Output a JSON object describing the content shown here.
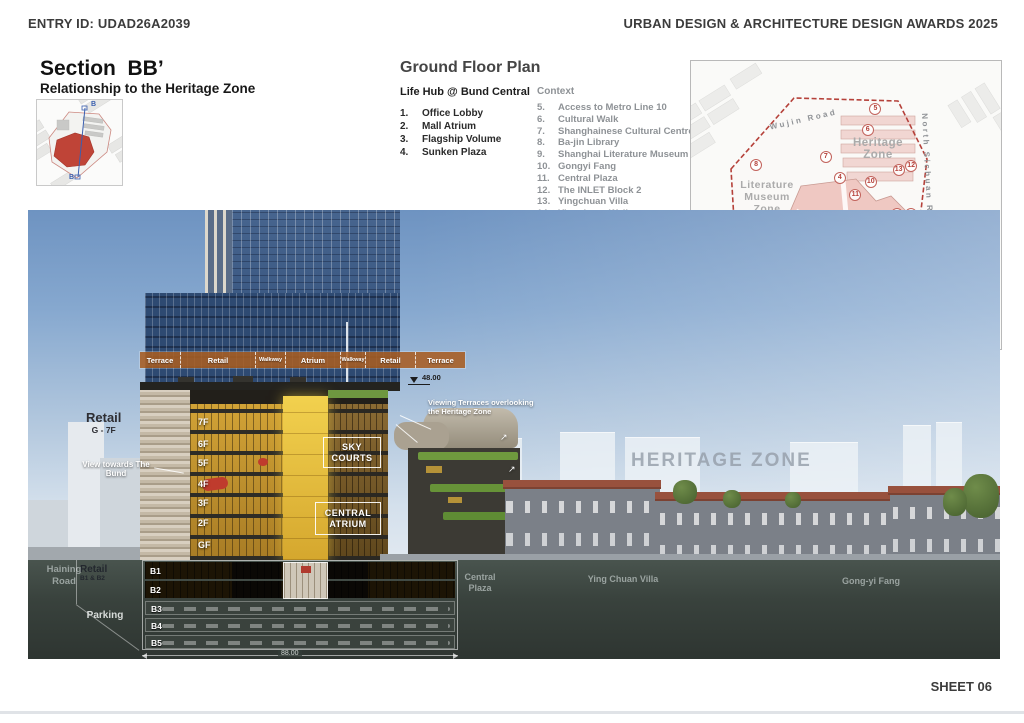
{
  "page": {
    "entry_id": "ENTRY ID: UDAD26A2039",
    "award_title": "URBAN DESIGN & ARCHITECTURE DESIGN AWARDS 2025",
    "sheet_no": "SHEET 06"
  },
  "title": {
    "heading": "Section  BB’",
    "subheading": "Relationship to the Heritage Zone",
    "keyplan_mark_top": "B",
    "keyplan_mark_bottom": "B"
  },
  "gfp": {
    "heading": "Ground Floor Plan",
    "subheading": "Life Hub @ Bund Central",
    "items": [
      {
        "num": "1.",
        "label": "Office Lobby"
      },
      {
        "num": "2.",
        "label": "Mall Atrium"
      },
      {
        "num": "3.",
        "label": "Flagship Volume"
      },
      {
        "num": "4.",
        "label": "Sunken Plaza"
      }
    ]
  },
  "ctx": {
    "heading": "Context",
    "items": [
      {
        "num": "5.",
        "label": "Access to Metro Line 10"
      },
      {
        "num": "6.",
        "label": "Cultural Walk"
      },
      {
        "num": "7.",
        "label": "Shanghainese Cultural Centre"
      },
      {
        "num": "8.",
        "label": "Ba-jin Library"
      },
      {
        "num": "9.",
        "label": "Shanghai Literature Museum"
      },
      {
        "num": "10.",
        "label": "Gongyi Fang"
      },
      {
        "num": "11.",
        "label": "Central Plaza"
      },
      {
        "num": "12.",
        "label": "The INLET Block 2"
      },
      {
        "num": "13.",
        "label": "Yingchuan Villa"
      },
      {
        "num": "14.",
        "label": "Yingchuan Walk"
      }
    ]
  },
  "map": {
    "roads": {
      "wujin": "Wujin Road",
      "north_sichuan": "North Sichuan Road",
      "north_jiangxi": "North Jiangxi Road",
      "haining": "Haining Road"
    },
    "zones": {
      "heritage": "Heritage Zone",
      "literature": "Literature Museum Zone"
    },
    "markers": [
      {
        "label": "1",
        "x": 42,
        "y": 78
      },
      {
        "label": "2",
        "x": 54,
        "y": 61
      },
      {
        "label": "3",
        "x": 66.5,
        "y": 53
      },
      {
        "label": "4",
        "x": 48,
        "y": 40.5
      },
      {
        "label": "5",
        "x": 59.5,
        "y": 16.5
      },
      {
        "label": "6",
        "x": 57,
        "y": 24
      },
      {
        "label": "7",
        "x": 43.5,
        "y": 33.5
      },
      {
        "label": "8",
        "x": 21,
        "y": 36
      },
      {
        "label": "9",
        "x": 24,
        "y": 56
      },
      {
        "label": "10",
        "x": 58,
        "y": 42
      },
      {
        "label": "11",
        "x": 53,
        "y": 46.5
      },
      {
        "label": "12",
        "x": 71,
        "y": 36.5
      },
      {
        "label": "13",
        "x": 67,
        "y": 38
      },
      {
        "label": "14",
        "x": 71,
        "y": 53
      }
    ],
    "scale_ticks": [
      "0",
      "10",
      "20",
      "50",
      "100"
    ],
    "north": "N",
    "boundary_color": "#b5413a"
  },
  "sec": {
    "program_strip": [
      "Terrace",
      "Retail",
      "Walkway",
      "Atrium",
      "Walkway",
      "Retail",
      "Terrace"
    ],
    "level_annotation": "48.00",
    "width_dimension": "88.00",
    "floors": [
      "7F",
      "6F",
      "5F",
      "4F",
      "3F",
      "2F",
      "GF"
    ],
    "basements": [
      "B1",
      "B2",
      "B3",
      "B4",
      "B5"
    ],
    "annotations": {
      "retail_upper_title": "Retail",
      "retail_upper_range": "G - 7F",
      "view_bund": "View towards The Bund",
      "viewing_terraces": "Viewing Terraces overlooking the Heritage Zone",
      "sky_courts": "SKY COURTS",
      "central_atrium": "CENTRAL ATRIUM",
      "heritage_zone": "HERITAGE ZONE",
      "haining_road": "Haining Road",
      "retail_lower_title": "Retail",
      "retail_lower_range": "B1 & B2",
      "parking": "Parking",
      "central_plaza": "Central Plaza",
      "ying_chuan_villa": "Ying Chuan Villa",
      "gongyi_fang": "Gong-yi Fang"
    }
  },
  "colors": {
    "accent_red": "#b5413a",
    "strip_orange": "#a85d22",
    "atrium_yellow": "#e9c53c",
    "heritage_roof": "#98513d"
  }
}
